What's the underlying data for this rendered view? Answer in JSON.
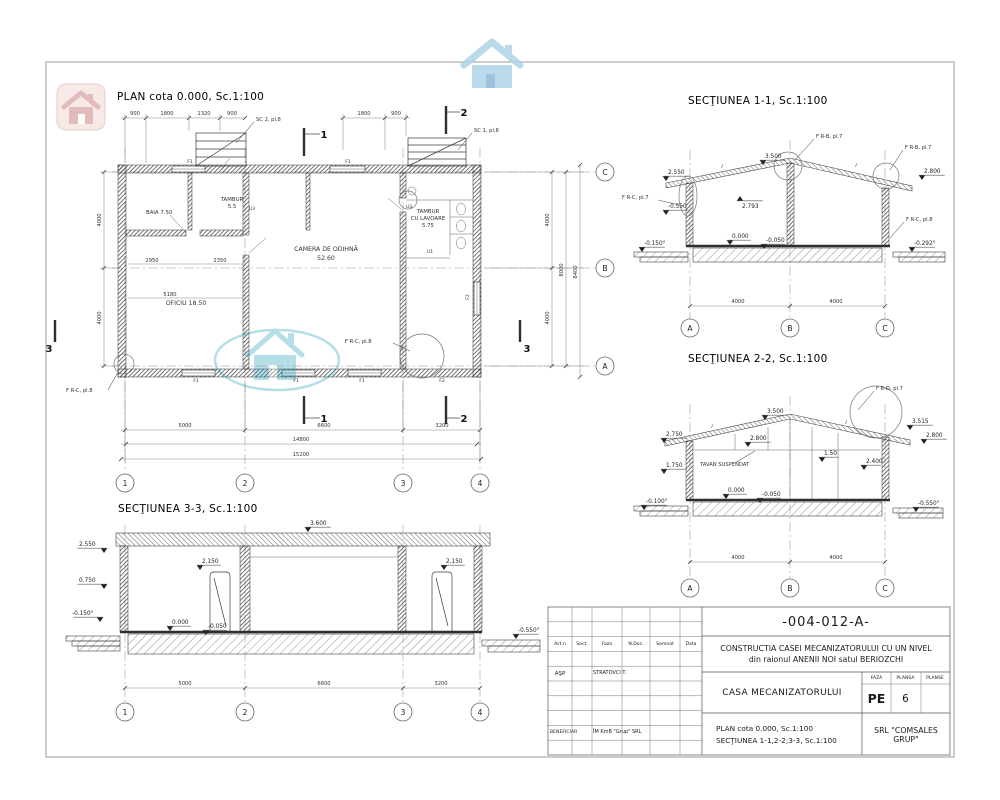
{
  "colors": {
    "watermark_teal": "#1b9cb4",
    "watermark_red": "#cf8f8f",
    "watermark_blue": "#aed3e8"
  },
  "icons": {
    "watermark_red": "house-icon",
    "watermark_blue": "house-icon",
    "watermark_teal": "house-icon"
  },
  "plan": {
    "title": "PLAN cota 0.000, Sc.1:100",
    "rooms": {
      "baia": "BAIA 7.50",
      "tambur1": "TAMBUR",
      "tambur2": "5.5",
      "camera1": "CAMERA DE ODIHNĂ",
      "camera2": "52.60",
      "oficiu": "OFICIU 18.50",
      "lav1": "TAMBUR",
      "lav2": "CU LAVOARE",
      "lav3": "5.75"
    },
    "callouts": {
      "sc2": "SC 2, pl.8",
      "sc1": "SC 1, pl.8",
      "frc8": "F R-C, pl.8"
    },
    "dims": {
      "top": [
        "900",
        "1800",
        "1320",
        "900"
      ],
      "top_right": [
        "1800",
        "900"
      ],
      "bottom": [
        "5000",
        "6600",
        "3200"
      ],
      "total1": "14800",
      "total2": "15200",
      "left": [
        "4000",
        "4000"
      ],
      "right": [
        "4000",
        "4000"
      ],
      "right_sub": "8000",
      "right_total": "8400",
      "inner": [
        "2950",
        "2350",
        "5180"
      ]
    },
    "tags": {
      "f1": "F1",
      "f2": "F2",
      "u1": "U1",
      "u3": "U3"
    },
    "grid_cols": [
      "1",
      "2",
      "3",
      "4"
    ],
    "grid_rows": [
      "C",
      "B",
      "A"
    ],
    "cuts": {
      "c1": "1",
      "c2": "2",
      "c3": "3"
    }
  },
  "sec11": {
    "title": "SECŢIUNEA 1-1, Sc.1:100",
    "slope": "i",
    "levels": {
      "eave_left": "2.550",
      "ridge": "3.500",
      "under_roof": "2.793",
      "eave_right": "2.800",
      "wall_left": "-0.550",
      "zero": "0.000",
      "floor": "-0.050",
      "ground_left": "-0.150°",
      "ground_right": "-0.292°"
    },
    "callouts": {
      "frb7": "F R-B, pl.7",
      "frc7": "F R-C, pl.7",
      "frc8": "F R-C, pl.8"
    },
    "dims": [
      "4000",
      "4000"
    ],
    "grid": [
      "A",
      "B",
      "C"
    ]
  },
  "sec22": {
    "title": "SECŢIUNEA 2-2, Sc.1:100",
    "slope": "i",
    "tavan": "TAVAN SUSPENDAT",
    "levels": {
      "ridge": "3.500",
      "right_top": "3.515",
      "eave_right": "2.800",
      "eave_left": "2.750",
      "inner": "2.800",
      "mid_left": "1.750",
      "post": "1.50",
      "inner_right": "2.400",
      "zero": "0.000",
      "floor": "-0.050",
      "ground_left": "-0.100°",
      "ground_right": "-0.550°"
    },
    "callouts": {
      "frd7": "F R-D, pl.7"
    },
    "dims": [
      "4000",
      "4000"
    ],
    "grid": [
      "A",
      "B",
      "C"
    ]
  },
  "sec33": {
    "title": "SECŢIUNEA 3-3, Sc.1:100",
    "levels": {
      "top": "3.600",
      "eave_left": "2.550",
      "sill": "0.750",
      "ground_left": "-0.150°",
      "door": "2.150",
      "zero": "0.000",
      "floor": "-0.050",
      "ground_right": "-0.550°"
    },
    "dims": [
      "5000",
      "6600",
      "3200"
    ],
    "grid": [
      "1",
      "2",
      "3",
      "4"
    ]
  },
  "titleblock": {
    "doc_number": "-004-012-A-",
    "project1": "CONSTRUCTIA  CASEI MECANIZATORULUI CU UN NIVEL",
    "project2": "din  raionul ANENII NOI satul BERIOZCHI",
    "object": "CASA MECANIZATORULUI",
    "faza_label": "FAZA",
    "faza": "PE",
    "plansa_label": "PLANSA",
    "plansa": "6",
    "planse_label": "PLANSE",
    "planse": "",
    "content1": "PLAN cota 0.000, Sc.1:100",
    "content2": "SECŢIUNEA 1-1,2-2;3-3, Sc.1:100",
    "firm": "SRL  \"COMSALES GRUP\"",
    "cols": [
      "Act.n",
      "Sect.",
      "Faza",
      "N.Doc.",
      "Semnat",
      "Data"
    ],
    "asp": "AŞP",
    "proiectant": "STRATOVCI T.",
    "beneficiar_label": "BENEFICIAR",
    "beneficiar": "ÎM KmB \"Grup\" SRL"
  }
}
